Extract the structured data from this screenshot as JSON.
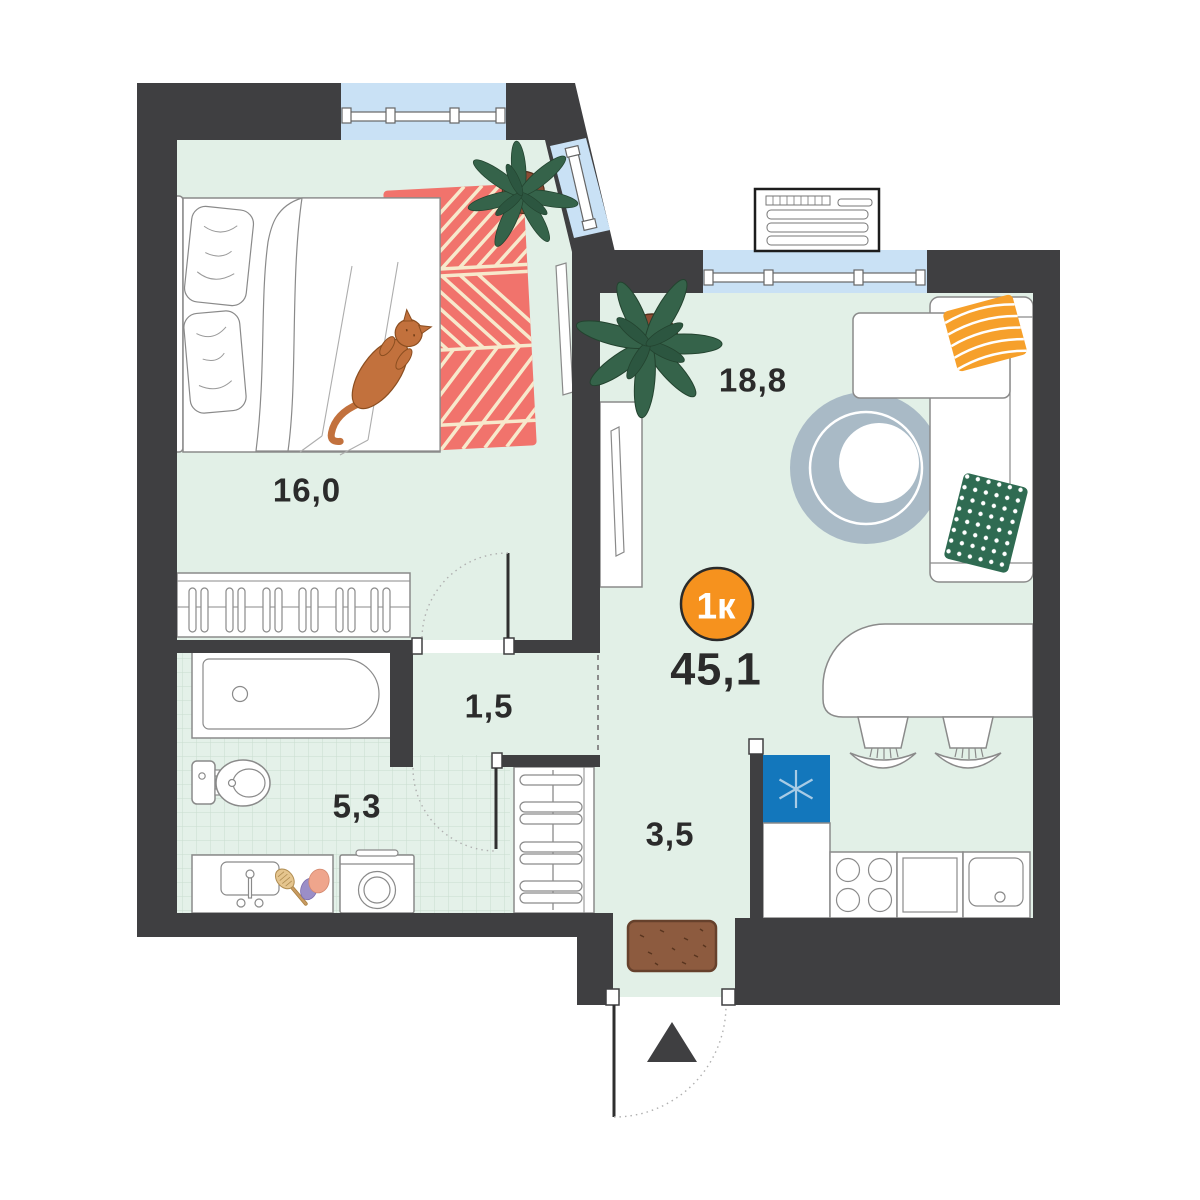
{
  "plan": {
    "badge": {
      "label": "1к",
      "color": "#F6921E"
    },
    "total_area": "45,1",
    "rooms": [
      {
        "key": "bedroom",
        "area": "16,0"
      },
      {
        "key": "living_kitchen",
        "area": "18,8"
      },
      {
        "key": "hall",
        "area": "1,5"
      },
      {
        "key": "bathroom",
        "area": "5,3"
      },
      {
        "key": "entry_hall",
        "area": "3,5"
      }
    ],
    "icons": {
      "fridge": "snowflake-icon",
      "entrance_direction": "up-triangle-icon"
    },
    "colors": {
      "wall": "#3F3F41",
      "floor": "#E2F0E7",
      "tile_line": "#C9DDCE",
      "window": "#C9E1F5",
      "badge": "#F6921E",
      "rug_red": "#F1736C",
      "rug_stripe": "#F7E9CC",
      "rug_round": "#A9BAC6",
      "fridge_blue": "#1377BC",
      "pillow_orange": "#F6A02B",
      "pillow_green": "#2F6B52",
      "doormat_brown": "#8D5B3F",
      "plant_green": "#35634A",
      "pot_brown": "#8C4B33",
      "cat_orange": "#C2713D",
      "text": "#2B2B2B"
    }
  }
}
